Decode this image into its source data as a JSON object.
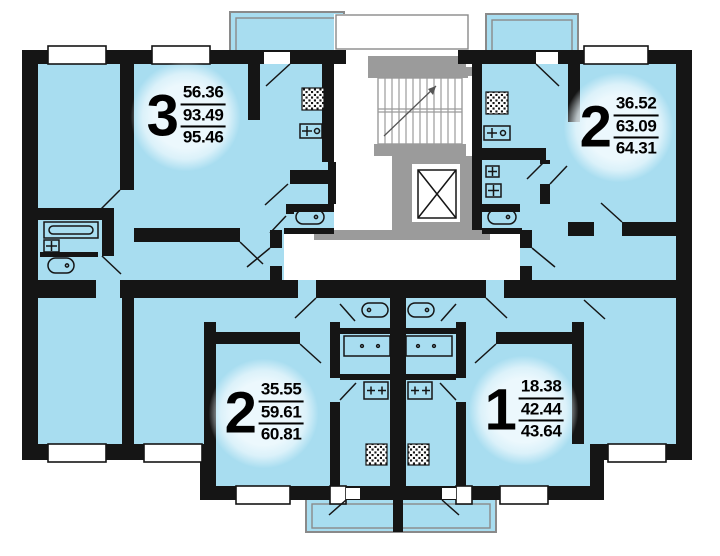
{
  "plan": {
    "type": "apartment-floor-plan",
    "colors": {
      "room": "#a8ddf0",
      "wall": "#151515",
      "core": "#9b9b9b",
      "outline": "#8a8a8a",
      "background": "#ffffff"
    },
    "apartments": [
      {
        "name": "three-room-upper-left",
        "rooms": "3",
        "areas": [
          "56.36",
          "93.49",
          "95.46"
        ]
      },
      {
        "name": "two-room-upper-right",
        "rooms": "2",
        "areas": [
          "36.52",
          "63.09",
          "64.31"
        ]
      },
      {
        "name": "two-room-lower-left",
        "rooms": "2",
        "areas": [
          "35.55",
          "59.61",
          "60.81"
        ]
      },
      {
        "name": "one-room-lower-right",
        "rooms": "1",
        "areas": [
          "18.38",
          "42.44",
          "43.64"
        ]
      }
    ],
    "icons": {
      "staircase": "stair-treads-with-arrow",
      "elevator": "rect-with-x-cross",
      "bathtub": "stadium-outline-with-drain-dot",
      "toilet": "oval-with-dot",
      "sink": "box-with-cross",
      "stove": "box-with-plus-marks",
      "vent_shaft": "hatched-square",
      "window": "white-slot-in-wall",
      "door": "diagonal-swing-line",
      "balcony": "outlined-blue-rect"
    }
  }
}
